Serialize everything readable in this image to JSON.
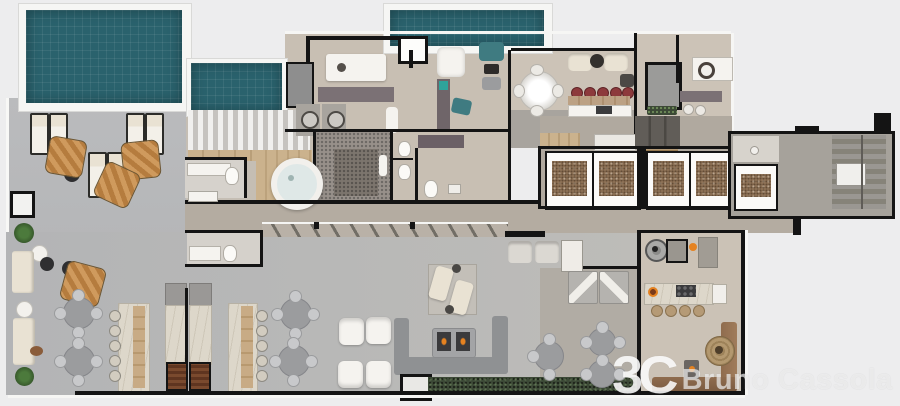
{
  "watermark": {
    "monogram": "3C",
    "name": "Bruno Cassola"
  },
  "palette": {
    "bg": "#ededee",
    "pool-water": "#2a626d",
    "pool-trim": "#f6f6f4",
    "deck": "#babbbd",
    "lounge": "#b3b4b6",
    "beige": "#c8bfb3",
    "beige-light": "#ccc3b7",
    "corridor": "#b4aca1",
    "carpet": "#a8a49e",
    "wood": "#cbb28d",
    "wall": "#141414",
    "white-furn": "#f5f3ef",
    "cream": "#e9e2d3",
    "gray-table": "#9b9c9e",
    "chair": "#c8c9cb",
    "sauna": "#97908a",
    "sauna-inner": "#7c756d",
    "lift-floor": "#93765a",
    "stool-red": "#8d3a3c",
    "teal": "#3f7b81",
    "hedge": "#3c4936",
    "brown-sofa": "#8f6c4e",
    "marble": "#ddd7ca",
    "plant": "#4c7a3c",
    "umbrella-a": "#cf9a5d",
    "umbrella-b": "#b57c3e",
    "fire": "#e58220",
    "counter-dark": "#7b7175"
  }
}
